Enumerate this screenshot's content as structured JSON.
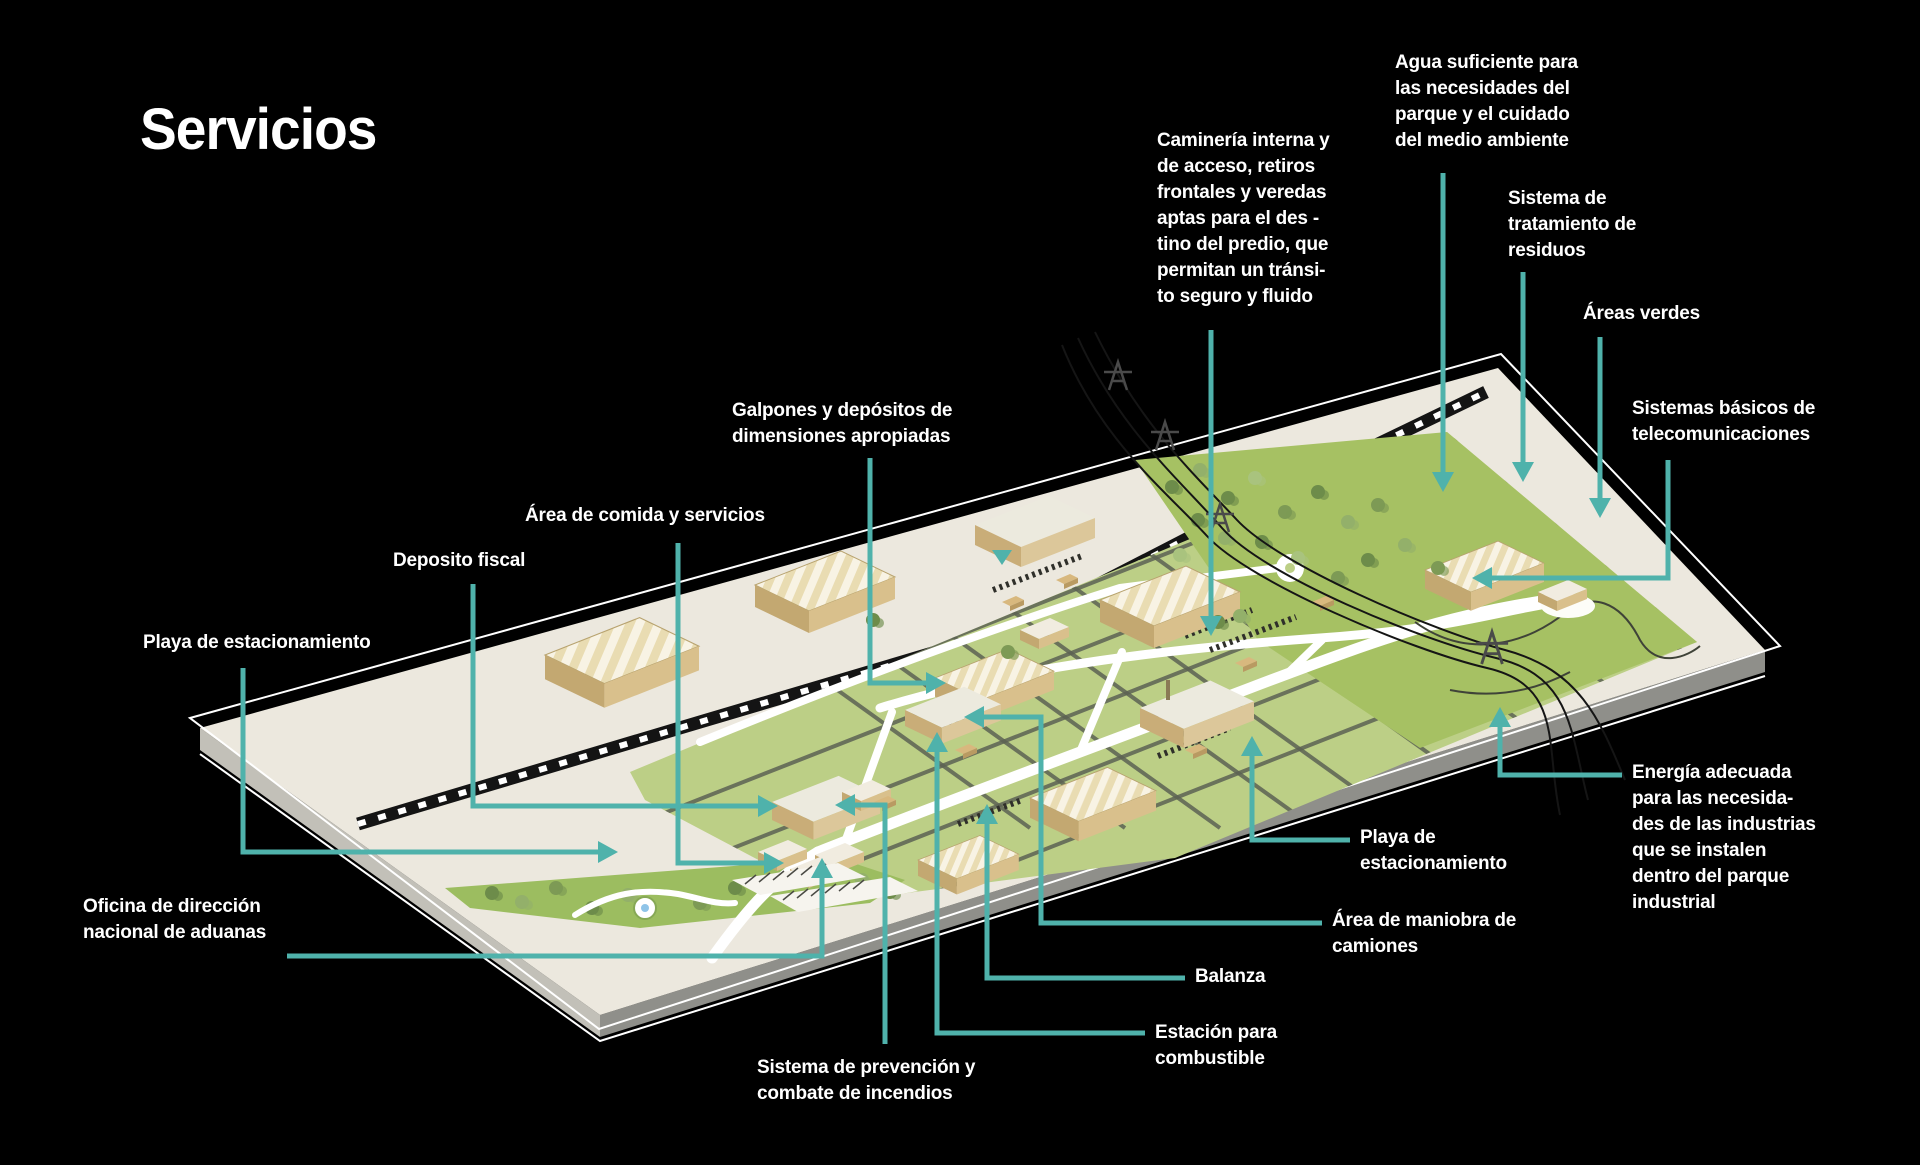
{
  "title": "Servicios",
  "colors": {
    "background": "#000000",
    "accent": "#4fb2ab",
    "text": "#ffffff"
  },
  "scene": {
    "plate_color": "#ece8de",
    "plate_side_color": "#8f8f8a",
    "railway_color": "#141414",
    "green_main": "#bccf86",
    "green_dark_field": "#a6c163",
    "green_entrance": "#9cbd60",
    "road_color": "#ffffff",
    "building_tan": "#d9c08c",
    "grid_line_color": "#5c6154"
  },
  "marker": {
    "id": "road-direction-marker",
    "x": 1002,
    "y": 557
  },
  "leader_style": {
    "stroke_width": 5,
    "arrow_length": 20,
    "arrow_half_width": 11
  },
  "labels": [
    {
      "id": "agua",
      "x": 1395,
      "y": 50,
      "text": "Agua suficiente para\nlas necesidades del\nparque y el cuidado\ndel medio ambiente"
    },
    {
      "id": "camineria",
      "x": 1157,
      "y": 128,
      "text": "Caminería interna y\nde acceso, retiros\nfrontales y veredas\naptas para el des -\ntino del predio, que\npermitan un tránsi-\nto seguro y fluido"
    },
    {
      "id": "tratamiento",
      "x": 1508,
      "y": 186,
      "text": "Sistema de\ntratamiento de\nresiduos"
    },
    {
      "id": "areas-verdes",
      "x": 1583,
      "y": 301,
      "text": "Áreas verdes"
    },
    {
      "id": "telecom",
      "x": 1632,
      "y": 396,
      "text": "Sistemas básicos de\ntelecomunicaciones"
    },
    {
      "id": "galpones",
      "x": 732,
      "y": 398,
      "text": "Galpones y depósitos de\ndimensiones apropiadas"
    },
    {
      "id": "comida",
      "x": 525,
      "y": 503,
      "text": "Área de comida y servicios"
    },
    {
      "id": "deposito",
      "x": 393,
      "y": 548,
      "text": "Deposito fiscal"
    },
    {
      "id": "playa-izq",
      "x": 143,
      "y": 630,
      "text": "Playa de estacionamiento"
    },
    {
      "id": "oficina",
      "x": 83,
      "y": 894,
      "text": "Oficina de dirección\nnacional de aduanas"
    },
    {
      "id": "prevencion",
      "x": 757,
      "y": 1055,
      "text": "Sistema de prevención y\ncombate de incendios"
    },
    {
      "id": "estacion",
      "x": 1155,
      "y": 1020,
      "text": "Estación para\ncombustible"
    },
    {
      "id": "balanza",
      "x": 1195,
      "y": 964,
      "text": "Balanza"
    },
    {
      "id": "maniobra",
      "x": 1332,
      "y": 908,
      "text": "Área de maniobra de\ncamiones"
    },
    {
      "id": "playa-der",
      "x": 1360,
      "y": 825,
      "text": "Playa de\nestacionamiento"
    },
    {
      "id": "energia",
      "x": 1632,
      "y": 760,
      "text": "Energía adecuada\npara las necesida-\ndes de las industrias\nque se instalen\ndentro del parque\nindustrial"
    }
  ],
  "leaders": [
    {
      "id": "agua",
      "points": [
        [
          1443,
          173
        ],
        [
          1443,
          472
        ]
      ]
    },
    {
      "id": "camineria",
      "points": [
        [
          1211,
          330
        ],
        [
          1211,
          616
        ]
      ]
    },
    {
      "id": "tratamiento",
      "points": [
        [
          1523,
          272
        ],
        [
          1523,
          462
        ]
      ]
    },
    {
      "id": "areas-verdes",
      "points": [
        [
          1600,
          337
        ],
        [
          1600,
          498
        ]
      ]
    },
    {
      "id": "telecom",
      "points": [
        [
          1668,
          460
        ],
        [
          1668,
          578
        ],
        [
          1492,
          578
        ]
      ]
    },
    {
      "id": "galpones",
      "points": [
        [
          870,
          458
        ],
        [
          870,
          683
        ],
        [
          926,
          683
        ]
      ]
    },
    {
      "id": "comida",
      "points": [
        [
          678,
          543
        ],
        [
          678,
          863
        ],
        [
          764,
          863
        ]
      ]
    },
    {
      "id": "deposito",
      "points": [
        [
          473,
          584
        ],
        [
          473,
          806
        ],
        [
          758,
          806
        ]
      ]
    },
    {
      "id": "playa-izq",
      "points": [
        [
          243,
          668
        ],
        [
          243,
          852
        ],
        [
          598,
          852
        ]
      ]
    },
    {
      "id": "oficina",
      "points": [
        [
          287,
          956
        ],
        [
          822,
          956
        ],
        [
          822,
          878
        ]
      ]
    },
    {
      "id": "prevencion",
      "points": [
        [
          885,
          1044
        ],
        [
          885,
          805
        ],
        [
          855,
          805
        ]
      ]
    },
    {
      "id": "estacion",
      "points": [
        [
          1145,
          1033
        ],
        [
          937,
          1033
        ],
        [
          937,
          752
        ]
      ]
    },
    {
      "id": "balanza",
      "points": [
        [
          1185,
          978
        ],
        [
          987,
          978
        ],
        [
          987,
          824
        ]
      ]
    },
    {
      "id": "maniobra",
      "points": [
        [
          1322,
          923
        ],
        [
          1041,
          923
        ],
        [
          1041,
          717
        ],
        [
          984,
          717
        ]
      ]
    },
    {
      "id": "playa-der",
      "points": [
        [
          1350,
          840
        ],
        [
          1252,
          840
        ],
        [
          1252,
          756
        ]
      ]
    },
    {
      "id": "energia",
      "points": [
        [
          1622,
          775
        ],
        [
          1500,
          775
        ],
        [
          1500,
          727
        ]
      ]
    }
  ]
}
